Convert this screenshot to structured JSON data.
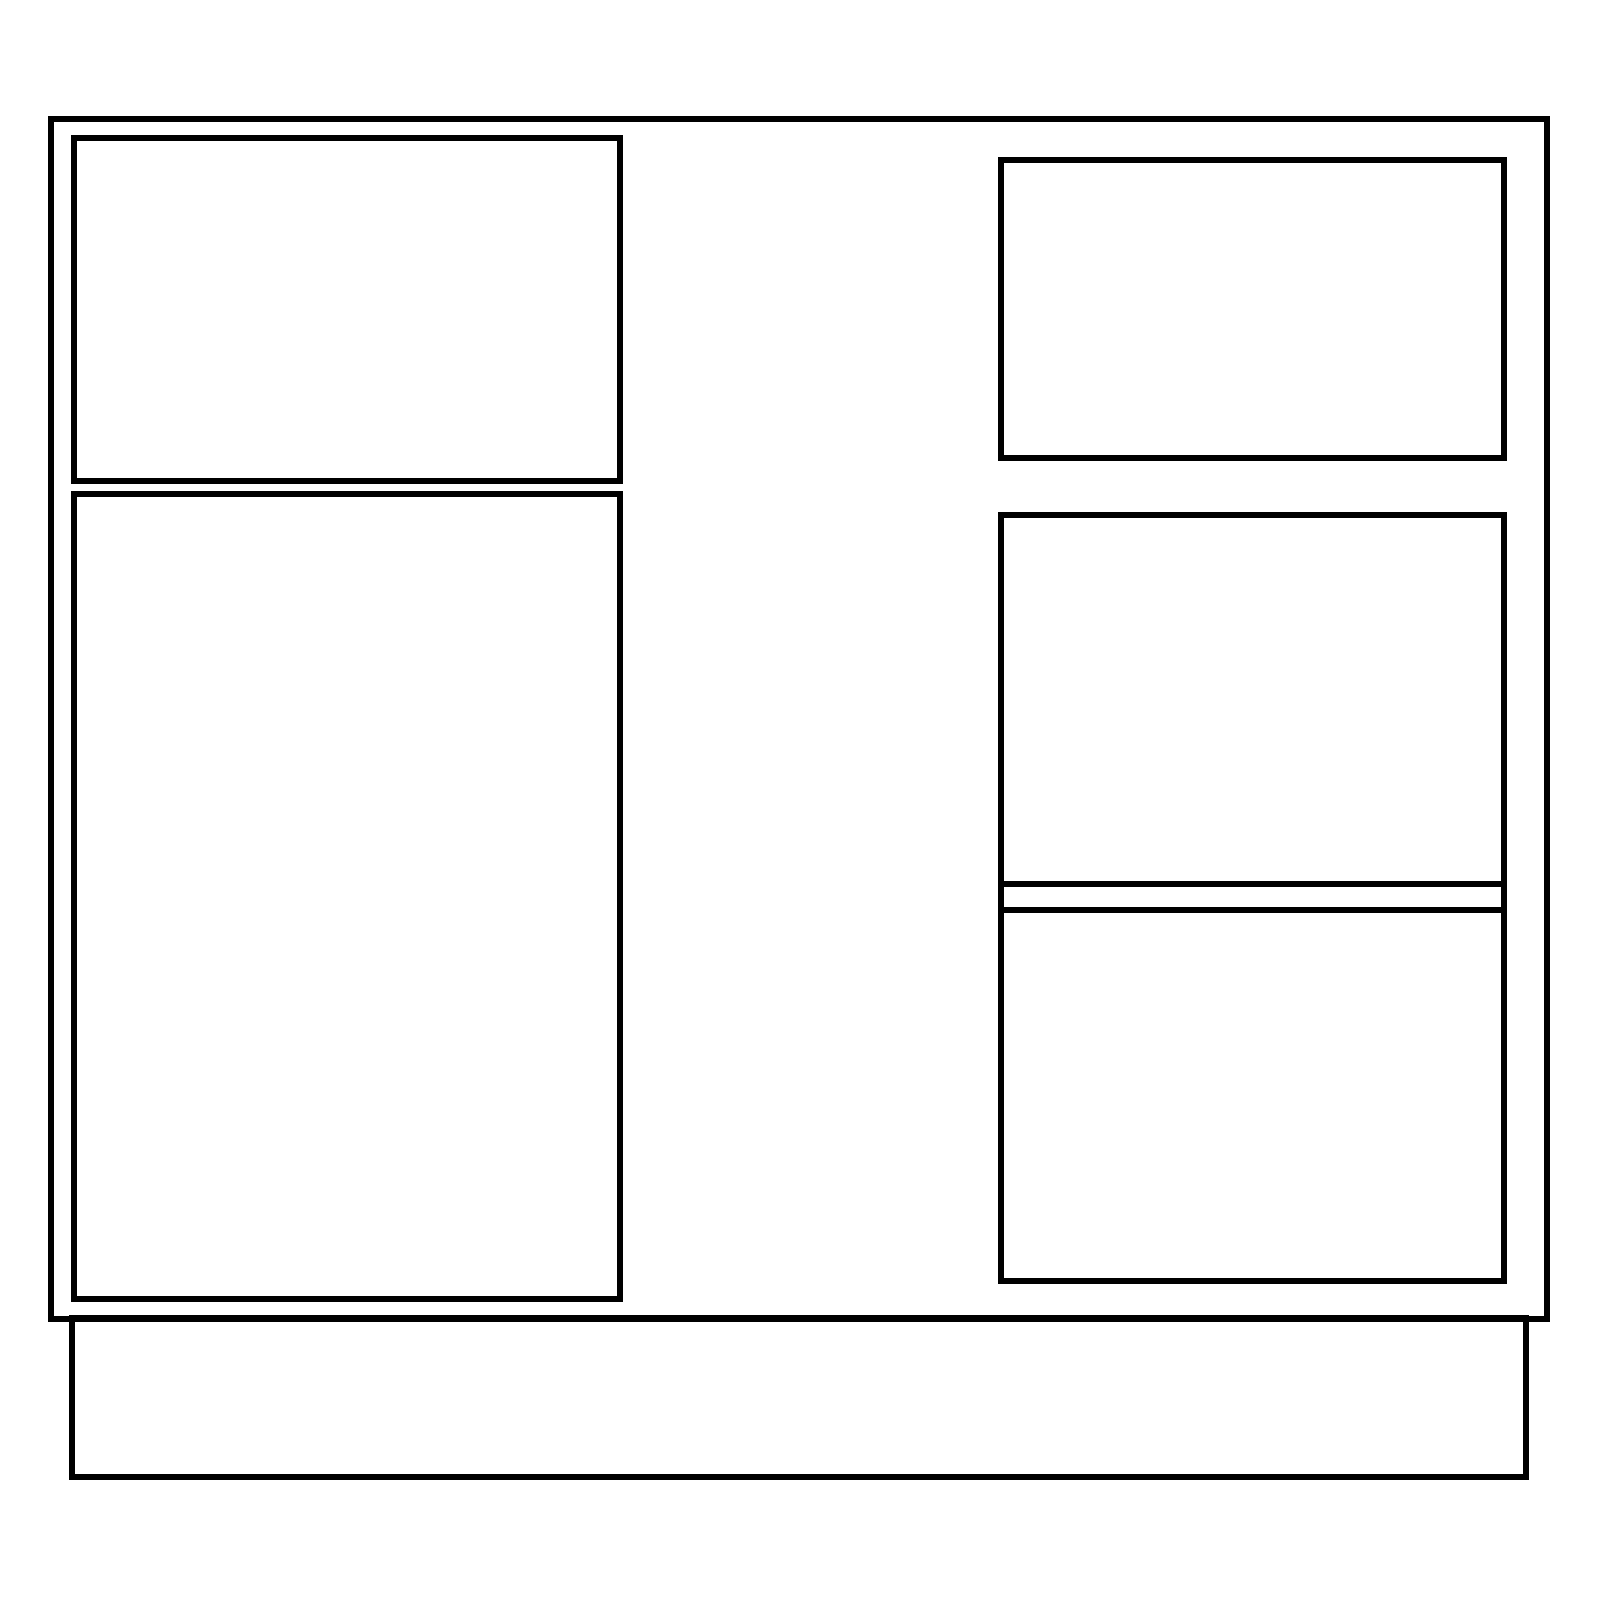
{
  "canvas": {
    "width": 1600,
    "height": 1600,
    "background": "#ffffff"
  },
  "style": {
    "stroke_color": "#000000",
    "stroke_width": 6
  },
  "diagram": {
    "type": "line-drawing",
    "subject": "cabinet-front-elevation",
    "shapes": [
      {
        "name": "cabinet-body-outline",
        "kind": "rect",
        "x": 48,
        "y": 116,
        "w": 1502,
        "h": 1206
      },
      {
        "name": "left-drawer-front",
        "kind": "rect",
        "x": 71,
        "y": 135,
        "w": 552,
        "h": 349
      },
      {
        "name": "left-door-panel",
        "kind": "rect",
        "x": 71,
        "y": 491,
        "w": 552,
        "h": 811
      },
      {
        "name": "right-top-drawer-front",
        "kind": "rect",
        "x": 998,
        "y": 157,
        "w": 509,
        "h": 304
      },
      {
        "name": "right-drawer-stack",
        "kind": "rect",
        "x": 998,
        "y": 512,
        "w": 509,
        "h": 772
      },
      {
        "name": "right-stack-divider-upper",
        "kind": "hline",
        "x": 998,
        "y": 881,
        "w": 509,
        "h": 6
      },
      {
        "name": "right-stack-divider-lower",
        "kind": "hline",
        "x": 998,
        "y": 907,
        "w": 509,
        "h": 6
      },
      {
        "name": "toe-kick-base",
        "kind": "rect",
        "x": 69,
        "y": 1315,
        "w": 1460,
        "h": 165
      }
    ]
  }
}
